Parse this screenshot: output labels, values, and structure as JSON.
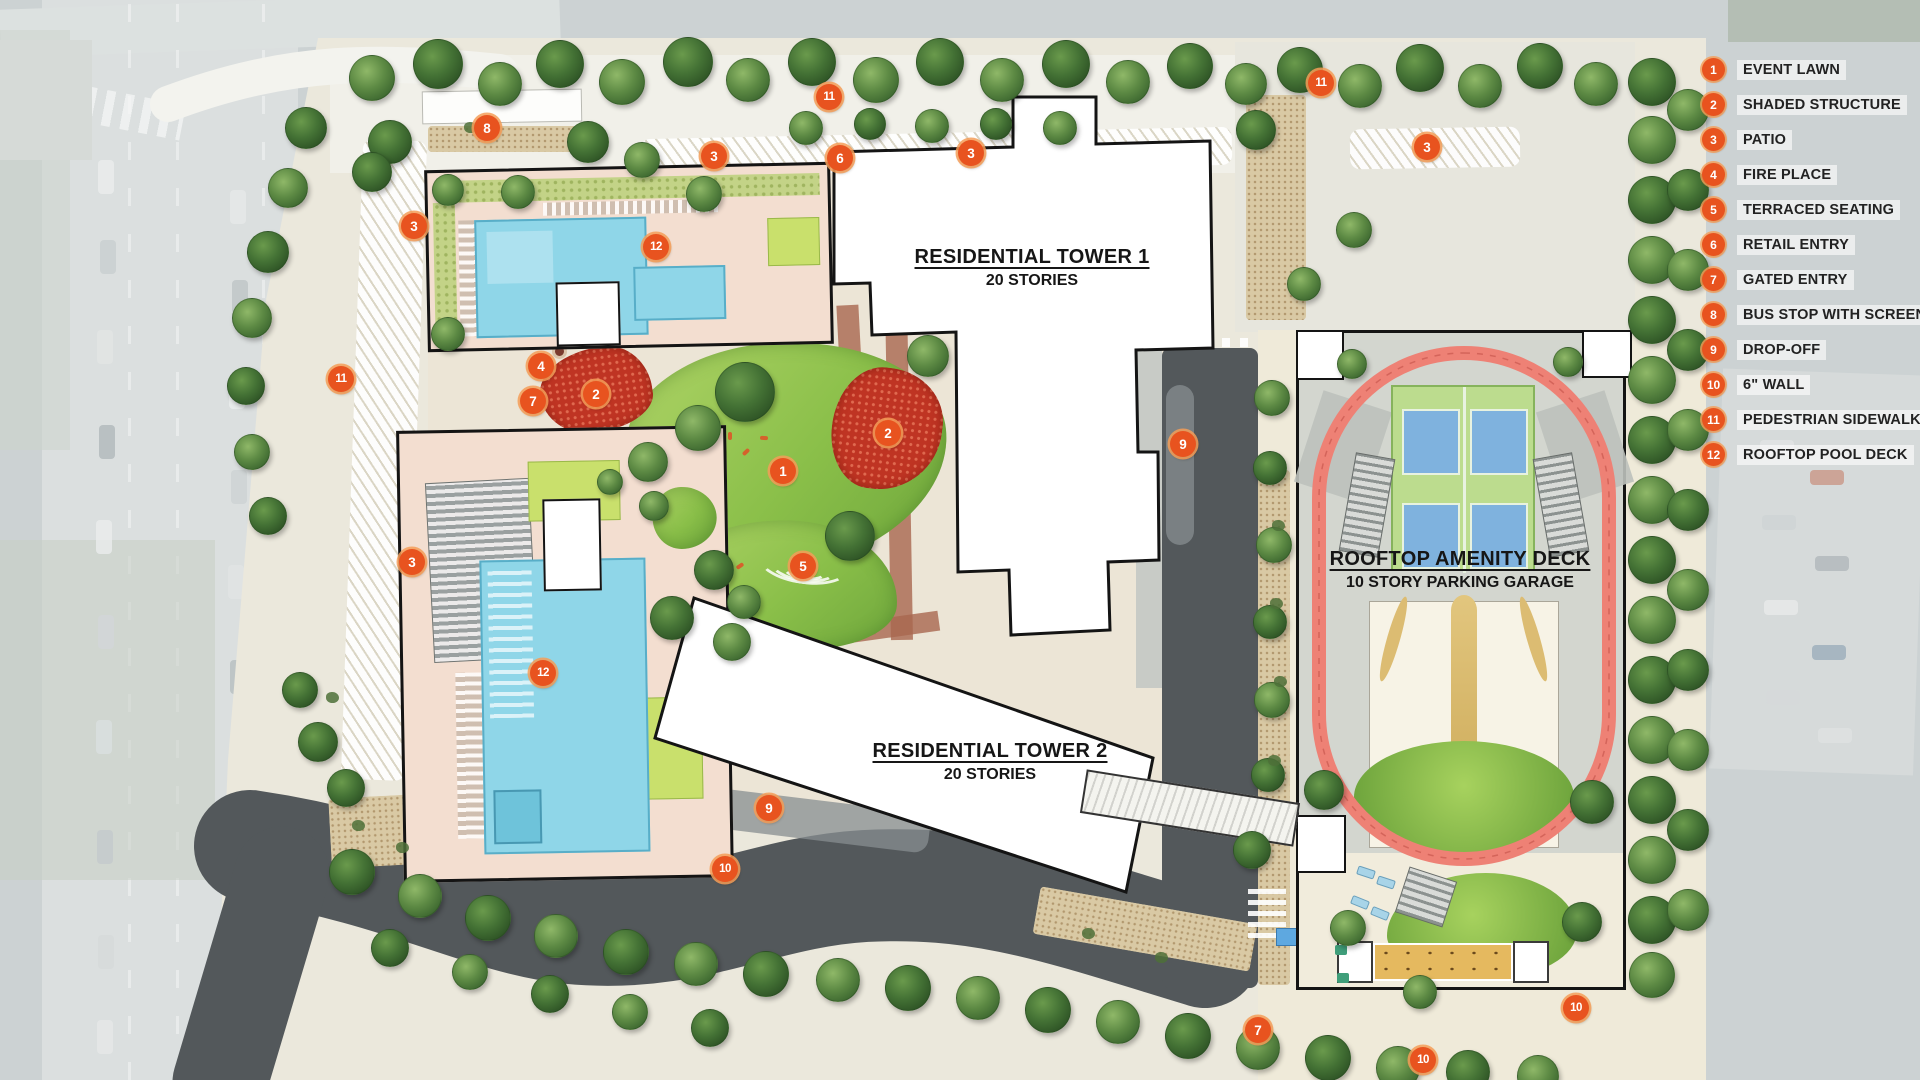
{
  "legend": {
    "items": [
      {
        "num": "1",
        "label": "EVENT LAWN"
      },
      {
        "num": "2",
        "label": "SHADED STRUCTURE"
      },
      {
        "num": "3",
        "label": "PATIO"
      },
      {
        "num": "4",
        "label": "FIRE PLACE"
      },
      {
        "num": "5",
        "label": "TERRACED SEATING"
      },
      {
        "num": "6",
        "label": "RETAIL ENTRY"
      },
      {
        "num": "7",
        "label": "GATED ENTRY"
      },
      {
        "num": "8",
        "label": "BUS STOP WITH SCREEN"
      },
      {
        "num": "9",
        "label": "DROP-OFF"
      },
      {
        "num": "10",
        "label": "6\" WALL"
      },
      {
        "num": "11",
        "label": "PEDESTRIAN SIDEWALK"
      },
      {
        "num": "12",
        "label": "ROOFTOP POOL DECK"
      }
    ]
  },
  "labels": {
    "tower1": {
      "title": "RESIDENTIAL TOWER 1",
      "subtitle": "20 STORIES"
    },
    "tower2": {
      "title": "RESIDENTIAL TOWER 2",
      "subtitle": "20 STORIES"
    },
    "amenity": {
      "title": "ROOFTOP AMENITY DECK",
      "subtitle": "10 STORY PARKING GARAGE"
    }
  },
  "plan_markers": [
    {
      "num": "12",
      "x": 656,
      "y": 247
    },
    {
      "num": "3",
      "x": 414,
      "y": 226
    },
    {
      "num": "8",
      "x": 487,
      "y": 128
    },
    {
      "num": "3",
      "x": 714,
      "y": 156
    },
    {
      "num": "11",
      "x": 829,
      "y": 97
    },
    {
      "num": "6",
      "x": 840,
      "y": 158
    },
    {
      "num": "3",
      "x": 971,
      "y": 153
    },
    {
      "num": "11",
      "x": 1321,
      "y": 83
    },
    {
      "num": "3",
      "x": 1427,
      "y": 147
    },
    {
      "num": "11",
      "x": 341,
      "y": 379
    },
    {
      "num": "4",
      "x": 541,
      "y": 366
    },
    {
      "num": "7",
      "x": 533,
      "y": 401
    },
    {
      "num": "2",
      "x": 596,
      "y": 394
    },
    {
      "num": "2",
      "x": 888,
      "y": 433
    },
    {
      "num": "1",
      "x": 783,
      "y": 471
    },
    {
      "num": "5",
      "x": 803,
      "y": 566
    },
    {
      "num": "9",
      "x": 1183,
      "y": 444
    },
    {
      "num": "3",
      "x": 412,
      "y": 562
    },
    {
      "num": "12",
      "x": 543,
      "y": 673
    },
    {
      "num": "9",
      "x": 769,
      "y": 808
    },
    {
      "num": "10",
      "x": 725,
      "y": 869
    },
    {
      "num": "7",
      "x": 1258,
      "y": 1030
    },
    {
      "num": "10",
      "x": 1423,
      "y": 1060
    },
    {
      "num": "10",
      "x": 1576,
      "y": 1008
    }
  ],
  "colors": {
    "marker_orange": "#e8531f",
    "track_red": "#ee8175",
    "pool_blue": "#8fd6e8",
    "lawn_green": "#8abf49",
    "shade_structure_red": "#bf3423",
    "road_dark": "#53585b",
    "deck_pink": "#f3ded0",
    "deck_cream": "#f1ecdc",
    "court_green": "#bcdc8e",
    "court_blue": "#7fb2de"
  }
}
